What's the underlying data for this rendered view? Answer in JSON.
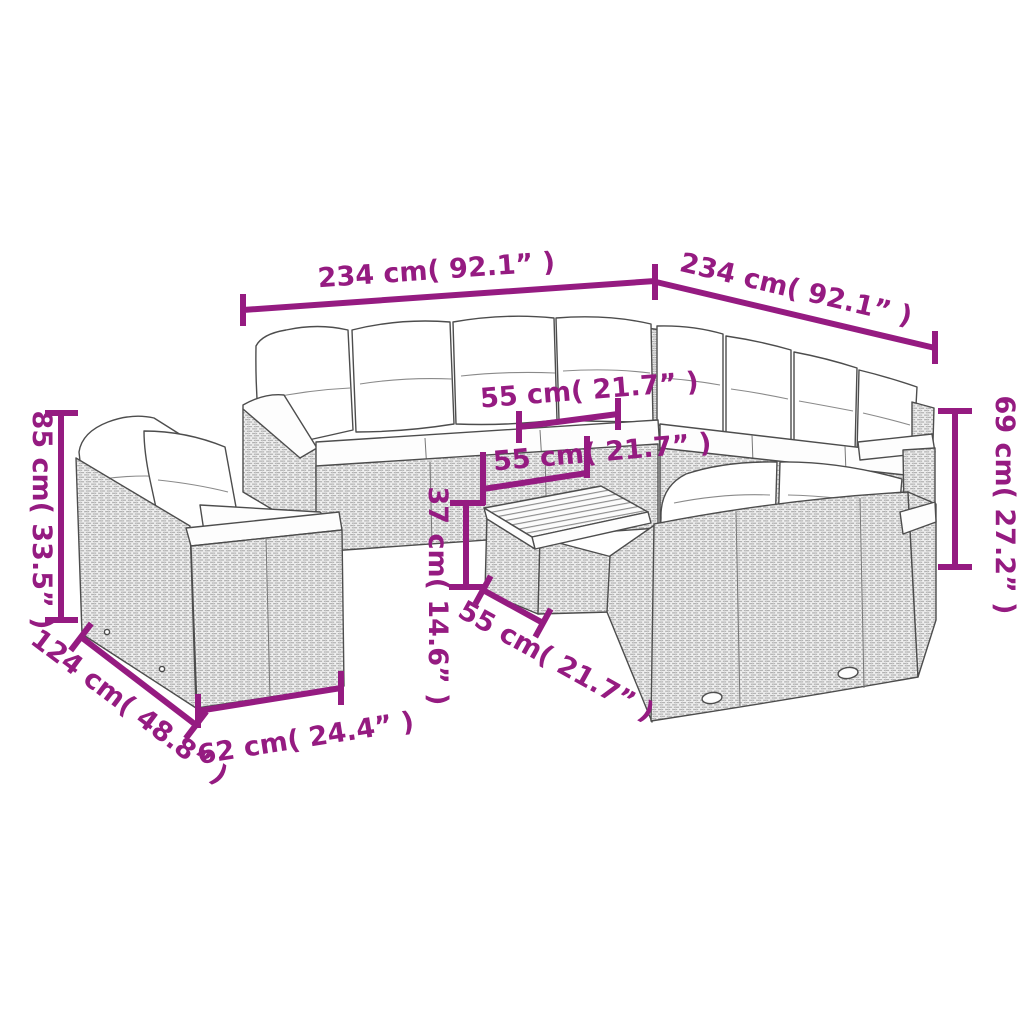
{
  "diagram": {
    "type": "product-dimension-diagram",
    "subject": "rattan garden lounge furniture set line drawing (corner sofa, armchair, two-seater sofa, coffee table)",
    "background": "#ffffff",
    "accent_color": "#951b81",
    "line_color": "#4d4d4d",
    "dims": {
      "top_left_width": "234 cm( 92.1” )",
      "top_right_width": "234 cm( 92.1” )",
      "left_height": "85 cm( 33.5” )",
      "right_height": "69 cm( 27.2” )",
      "seat_depth_upper": "55 cm( 21.7” )",
      "seat_depth_mid": "55 cm( 21.7” )",
      "table_height": "37 cm( 14.6” )",
      "seat_width_lower": "55 cm( 21.7” )",
      "armchair_depth": "124 cm( 48.8” )",
      "armchair_width": "62 cm( 24.4” )"
    }
  }
}
